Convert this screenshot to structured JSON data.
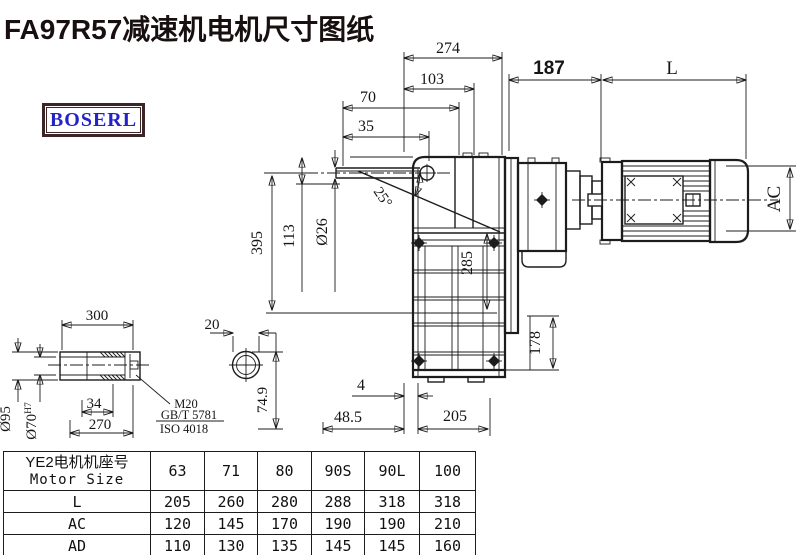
{
  "title": "FA97R57减速机电机尺寸图纸",
  "logo": {
    "text": "BOSERL"
  },
  "colors": {
    "title": "#181010",
    "logo_text": "#2323c6",
    "logo_border": "#3b2525",
    "line": "#1c1c1c"
  },
  "dimensions": {
    "overall_width": "274",
    "inner_width": "103",
    "shaft_ext": "70",
    "shaft_mid": "35",
    "adapter_len": "187",
    "motor_len": "L",
    "total_height": "395",
    "input_offset": "113",
    "input_shaft_dia": "Ø26",
    "tilt_angle": "25°",
    "case_height": "285",
    "base_height": "178",
    "motor_outer_dia": "AC",
    "base_gap": "4",
    "base_offset": "48.5",
    "base_len": "205"
  },
  "shaft_detail": {
    "len": "300",
    "bore_len": "270",
    "step_len": "34",
    "outer_dia": "Ø95",
    "bore_dia": "Ø70",
    "bore_fit": "H7",
    "thread": "M20",
    "standard1": "GB/T 5781",
    "standard2": "ISO 4018"
  },
  "section_detail": {
    "width": "20",
    "height": "74.9"
  },
  "table": {
    "header_cn": "YE2电机机座号",
    "header_en": "Motor Size",
    "sizes": [
      "63",
      "71",
      "80",
      "90S",
      "90L",
      "100"
    ],
    "rows": [
      {
        "label": "L",
        "values": [
          "205",
          "260",
          "280",
          "288",
          "318",
          "318"
        ]
      },
      {
        "label": "AC",
        "values": [
          "120",
          "145",
          "170",
          "190",
          "190",
          "210"
        ]
      },
      {
        "label": "AD",
        "values": [
          "110",
          "130",
          "135",
          "145",
          "145",
          "160"
        ]
      }
    ]
  }
}
